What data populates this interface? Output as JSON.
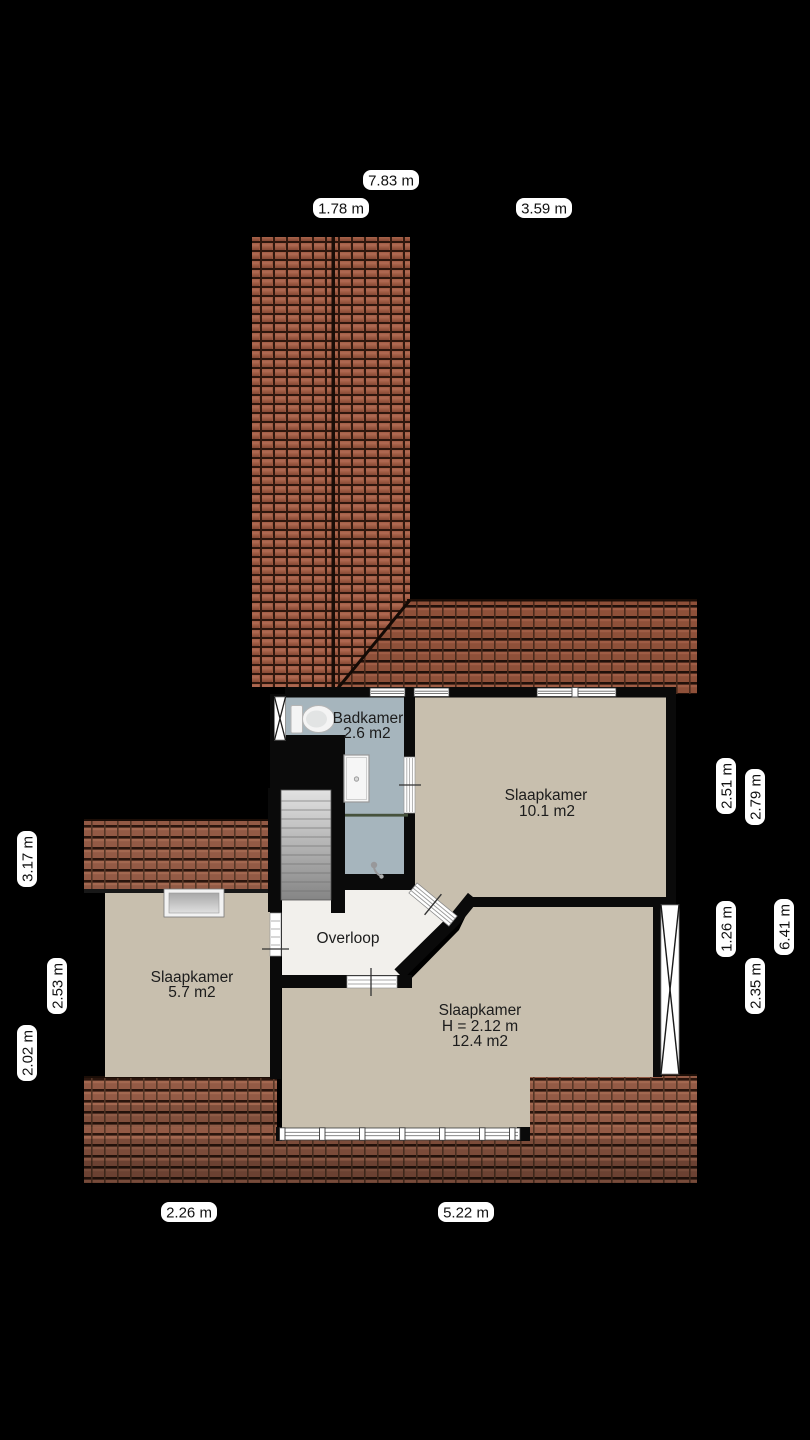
{
  "floorplan": {
    "type": "floor-plan",
    "rooms": {
      "badkamer": {
        "lines": [
          "Badkamer",
          "2.6 m2"
        ]
      },
      "slaapkamer_10": {
        "lines": [
          "Slaapkamer",
          "10.1 m2"
        ]
      },
      "overloop": {
        "lines": [
          "Overloop"
        ]
      },
      "slaapkamer_5": {
        "lines": [
          "Slaapkamer",
          "5.7 m2"
        ]
      },
      "slaapkamer_12": {
        "lines": [
          "Slaapkamer",
          "H = 2.12 m",
          "12.4 m2"
        ]
      }
    },
    "dimensions": {
      "top": [
        "7.83 m",
        "1.78 m",
        "3.59 m"
      ],
      "right": [
        "2.51 m",
        "2.79 m",
        "1.26 m",
        "6.41 m",
        "2.35 m"
      ],
      "left": [
        "3.17 m",
        "2.53 m",
        "2.02 m"
      ],
      "bottom": [
        "2.26 m",
        "5.22 m"
      ]
    },
    "colors": {
      "background": "#000000",
      "wall": "#0a0a0a",
      "roof_tile": "#8e5039",
      "bedroom_floor": "#c8bfae",
      "bathroom_floor": "#a6b5bd",
      "hall_floor": "#f2f0ec",
      "dimension_label_bg": "#ffffff"
    }
  }
}
